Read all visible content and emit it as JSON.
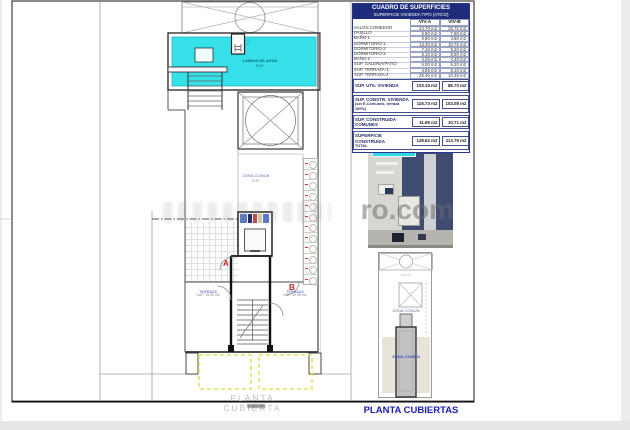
{
  "page": {
    "watermark": "ro.com",
    "sheet_title": "PLANTA CUBIERTAS",
    "plan_caption": "PLANTA CUBIERTA"
  },
  "plan": {
    "pool_label": "LAMINA DE AGUA",
    "pool_sub": "SUP:",
    "zona_comun_label": "ZONA COMUN",
    "zona_comun_sub": "SUP:",
    "terraza_left_label": "TERRAZA",
    "terraza_left_area": "SUP: 25.40 m2",
    "terraza_right_label": "TERRAZA",
    "terraza_right_area": "SUP: 10.45 m2",
    "door_a": "A",
    "door_b": "B"
  },
  "miniplan": {
    "zona_comun_label": "ZONA COMUN",
    "stair_label": "ZONA COMUN"
  },
  "table": {
    "title": "CUADRO DE SUPERFICIES",
    "subtitle": "SUPERFICIE VIVIENDA TIPO  (ATICO)",
    "col_a": "VIV-A",
    "col_b": "VIV-B",
    "rows": [
      {
        "label": "SALON COMEDOR",
        "a": "24.70 m2",
        "b": "26.70 m2"
      },
      {
        "label": "PASILLO",
        "a": "6.90 m2",
        "b": "7.50 m2"
      },
      {
        "label": "BAÑO-1",
        "a": "3.80 m2",
        "b": "3.80 m2"
      },
      {
        "label": "DORMITORIO-1",
        "a": "13.30 m2",
        "b": "10.75 m2"
      },
      {
        "label": "DORMITORIO-2",
        "a": "7.10 m2",
        "b": "8.20 m2"
      },
      {
        "label": "DORMITORIO-3",
        "a": "8.10 m2",
        "b": "8.50 m2"
      },
      {
        "label": "BAÑO-2",
        "a": "4.05 m2",
        "b": "4.40 m2"
      },
      {
        "label": "SUP. GALERIA/PATIO",
        "a": "5.00 m2",
        "b": "5.20 m2"
      },
      {
        "label": "SUP. TERRAZA-1",
        "a": "4.85 m2",
        "b": "8.10 m2"
      },
      {
        "label": "SUP. TERRAZA-2",
        "a": "25.40 m2",
        "b": "10.45 m2"
      }
    ],
    "totals": [
      {
        "label": "SUP. UTIL VIVIENDA",
        "label2": "",
        "a": "103.10 m2",
        "b": "86.70 m2"
      },
      {
        "label": "SUP. CONSTR. VIVIENDA",
        "label2": "(sin E.Comunes, terraza 100%)",
        "a": "116.73 m2",
        "b": "103.08 m2"
      },
      {
        "label": "SUP. CONSTRUIDA COMUNES",
        "label2": "",
        "a": "11.89 m2",
        "b": "10.71 m2"
      },
      {
        "label": "SUPERFICIE CONSTRUIDA",
        "label2": "TOTAL",
        "a": "128.62 m2",
        "b": "113.79 m2"
      }
    ]
  },
  "colors": {
    "accent_navy": "#1e2d7b",
    "title_blue": "#1c1cb0",
    "pool_cyan": "#35e0e8",
    "awning_yellow": "#e6e164",
    "marker_red": "#c22222"
  }
}
